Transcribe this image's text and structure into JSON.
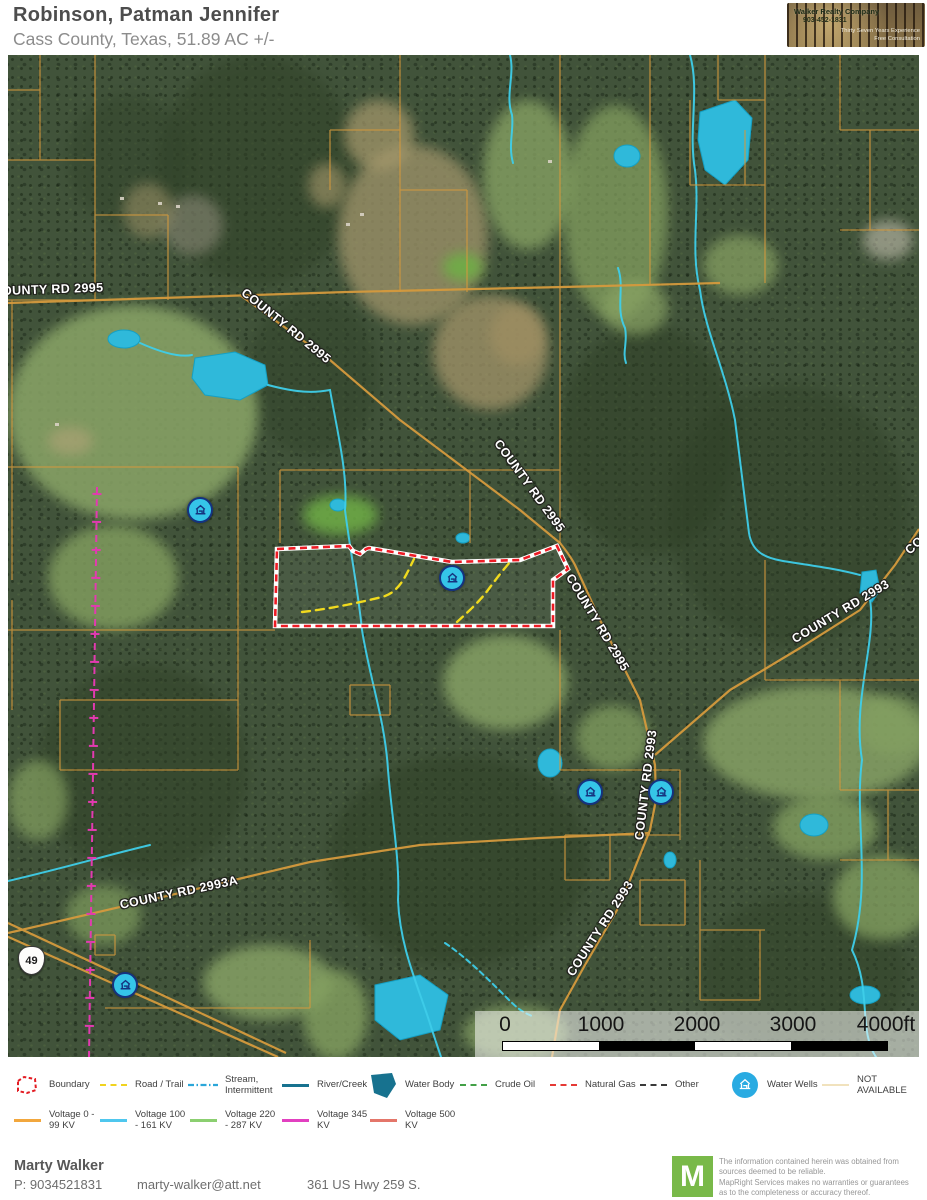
{
  "header": {
    "title": "Robinson, Patman Jennifer",
    "subtitle": "Cass County, Texas, 51.89 AC +/-",
    "logo": {
      "company": "Walker Realty Company",
      "phone": "903-452-1831",
      "tagline1": "Thirty Seven Years Experience",
      "tagline2": "Free Consultation"
    }
  },
  "map": {
    "road_labels": [
      {
        "text": "OUNTY RD 2995"
      },
      {
        "text": "COUNTY RD 2995"
      },
      {
        "text": "COUNTY RD 2995"
      },
      {
        "text": "COUNTY RD 2995"
      },
      {
        "text": "COUNTY RD 2993"
      },
      {
        "text": "COUNTY RD 2993"
      },
      {
        "text": "COUNTY RD 2993"
      },
      {
        "text": "COUNTY RD 2993A"
      },
      {
        "text": "COUNTY RD 2993"
      }
    ],
    "highway_shield": "49",
    "scale_bar": {
      "labels": [
        "0",
        "1000",
        "2000",
        "3000",
        "4000ft"
      ]
    },
    "colors": {
      "boundary": "#ee1c25",
      "trail": "#f0da1e",
      "stream": "#3ecde9",
      "water": "#2fb9da",
      "parcel": "#d59a3d",
      "powerline": "#e23ab0",
      "well": "#35c5e8"
    }
  },
  "legend": {
    "row1": [
      {
        "label": "Boundary",
        "color": "#e31c23"
      },
      {
        "label": "Road / Trail",
        "color": "#f0d31f"
      },
      {
        "label": "Stream, Intermittent",
        "color": "#2ba6d9"
      },
      {
        "label": "River/Creek",
        "color": "#17728f"
      },
      {
        "label": "Water Body",
        "color": "#17728f"
      },
      {
        "label": "Crude Oil",
        "color": "#43a047"
      },
      {
        "label": "Natural Gas",
        "color": "#e53935"
      },
      {
        "label": "Other",
        "color": "#3a3a3a"
      },
      {
        "label": "Water Wells",
        "color": "#29abe2"
      },
      {
        "label": "NOT AVAILABLE",
        "color": "#f1e2bd"
      }
    ],
    "row2": [
      {
        "label": "Voltage 0 - 99 KV",
        "color": "#f2a73d"
      },
      {
        "label": "Voltage 100 - 161 KV",
        "color": "#4fc7ee"
      },
      {
        "label": "Voltage 220 - 287 KV",
        "color": "#8bcf70"
      },
      {
        "label": "Voltage 345 KV",
        "color": "#e240c0"
      },
      {
        "label": "Voltage 500 KV",
        "color": "#e4766a"
      }
    ]
  },
  "footer": {
    "agent_name": "Marty Walker",
    "phone": "P: 9034521831",
    "email": "marty-walker@att.net",
    "address": "361 US Hwy 259 S.",
    "brand_letter": "M",
    "brand_color": "#79b949",
    "disclaimer": [
      "The information contained herein was obtained from",
      "sources deemed to be reliable.",
      "MapRight Services makes no warranties or guarantees",
      "as to the completeness or accuracy thereof."
    ]
  }
}
